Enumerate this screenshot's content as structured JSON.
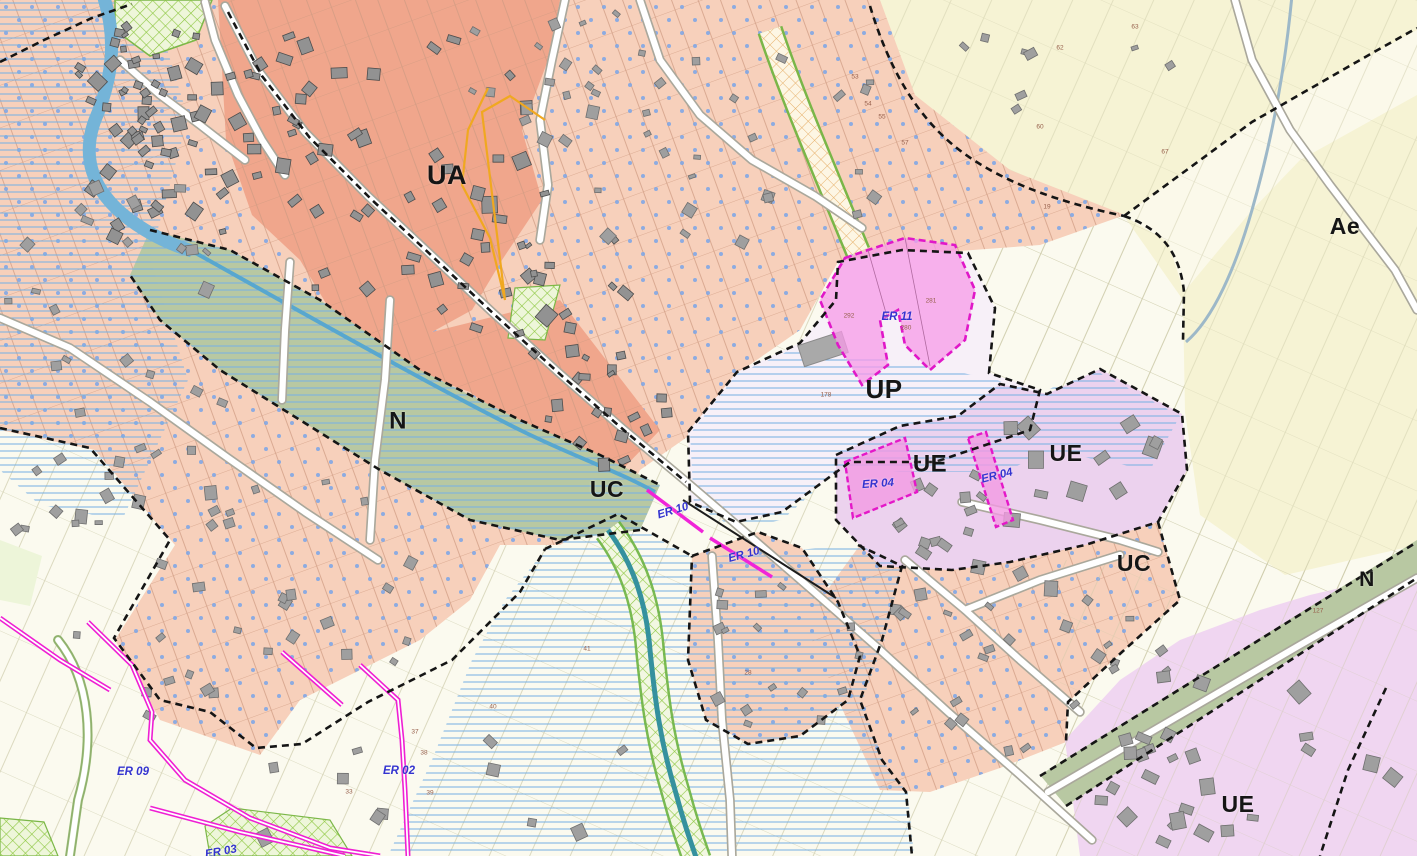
{
  "map": {
    "title": "zoning-plan-map",
    "zone_labels": [
      {
        "id": "ua",
        "text": "UA",
        "x": 447,
        "y": 177,
        "size": 27
      },
      {
        "id": "n-west",
        "text": "N",
        "x": 398,
        "y": 423,
        "size": 24
      },
      {
        "id": "uc-center",
        "text": "UC",
        "x": 607,
        "y": 491,
        "size": 23
      },
      {
        "id": "up",
        "text": "UP",
        "x": 884,
        "y": 391,
        "size": 26
      },
      {
        "id": "ue-center",
        "text": "UE",
        "x": 930,
        "y": 466,
        "size": 24
      },
      {
        "id": "ue-east",
        "text": "UE",
        "x": 1066,
        "y": 455,
        "size": 23
      },
      {
        "id": "uc-east",
        "text": "UC",
        "x": 1134,
        "y": 565,
        "size": 23
      },
      {
        "id": "ae",
        "text": "Ae",
        "x": 1345,
        "y": 228,
        "size": 23
      },
      {
        "id": "n-east",
        "text": "N",
        "x": 1367,
        "y": 581,
        "size": 21
      },
      {
        "id": "ue-southeast",
        "text": "UE",
        "x": 1238,
        "y": 806,
        "size": 23
      }
    ],
    "reserved_labels": [
      {
        "id": "er-11",
        "text": "ER 11",
        "x": 897,
        "y": 317,
        "rot": 0
      },
      {
        "id": "er-04-west",
        "text": "ER 04",
        "x": 878,
        "y": 484,
        "rot": -4
      },
      {
        "id": "er-04-east",
        "text": "ER 04",
        "x": 997,
        "y": 476,
        "rot": -14
      },
      {
        "id": "er-10-north",
        "text": "ER 10",
        "x": 673,
        "y": 511,
        "rot": -17
      },
      {
        "id": "er-10-south",
        "text": "ER 10",
        "x": 744,
        "y": 555,
        "rot": -15
      },
      {
        "id": "er-09",
        "text": "ER 09",
        "x": 133,
        "y": 772,
        "rot": 0
      },
      {
        "id": "er-02",
        "text": "ER 02",
        "x": 399,
        "y": 771,
        "rot": 0
      },
      {
        "id": "er-03",
        "text": "ER 03",
        "x": 221,
        "y": 852,
        "rot": -10
      }
    ],
    "parcel_numbers": [
      {
        "text": "292",
        "x": 849,
        "y": 316
      },
      {
        "text": "280",
        "x": 906,
        "y": 328
      },
      {
        "text": "281",
        "x": 931,
        "y": 301
      },
      {
        "text": "178",
        "x": 826,
        "y": 395
      },
      {
        "text": "41",
        "x": 587,
        "y": 649
      },
      {
        "text": "28",
        "x": 748,
        "y": 673
      },
      {
        "text": "37",
        "x": 415,
        "y": 732
      },
      {
        "text": "38",
        "x": 424,
        "y": 753
      },
      {
        "text": "39",
        "x": 430,
        "y": 793
      },
      {
        "text": "33",
        "x": 349,
        "y": 792
      },
      {
        "text": "40",
        "x": 493,
        "y": 707
      },
      {
        "text": "127",
        "x": 1318,
        "y": 611
      },
      {
        "text": "53",
        "x": 855,
        "y": 77
      },
      {
        "text": "54",
        "x": 868,
        "y": 104
      },
      {
        "text": "55",
        "x": 882,
        "y": 117
      },
      {
        "text": "57",
        "x": 905,
        "y": 143
      },
      {
        "text": "62",
        "x": 1060,
        "y": 48
      },
      {
        "text": "63",
        "x": 1135,
        "y": 27
      },
      {
        "text": "60",
        "x": 1040,
        "y": 127
      },
      {
        "text": "67",
        "x": 1165,
        "y": 152
      },
      {
        "text": "19",
        "x": 1047,
        "y": 207
      }
    ],
    "colors": {
      "zone_uc_salmon": "#f7d0bb",
      "zone_ua_salmon": "#f0a68c",
      "zone_up_lavender": "#f7f0f8",
      "zone_ue_lavender": "#ecd2ee",
      "zone_n_green": "#b8c8a2",
      "zone_a_yellow": "#f6f3d4",
      "base_cream": "#fbfaef",
      "er_magenta": "#ee22cc",
      "flood_hatch_blue": "#79b0e2",
      "parcel_dot_blue": "#7aa5e8",
      "river_blue": "#74b4d8",
      "stream_teal": "#35919e",
      "corridor_green": "#6cb23f",
      "building_grey": "#9f9f9f",
      "boundary_black": "#151515",
      "er_label_blue": "#3434cf"
    }
  }
}
